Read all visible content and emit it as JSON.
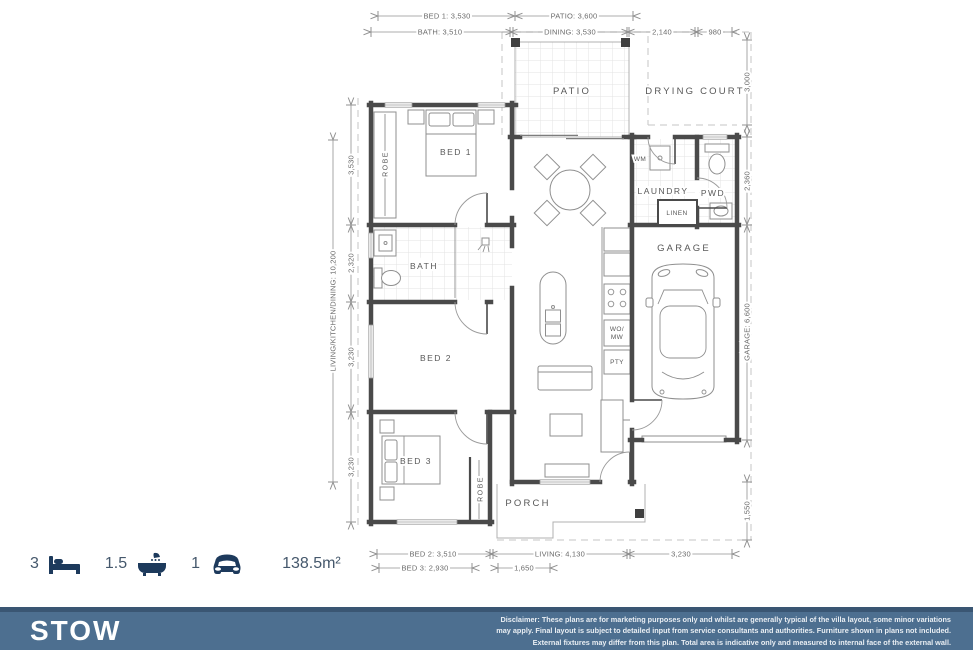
{
  "plan": {
    "dims_top": {
      "bed1": "BED 1: 3,530",
      "patio": "PATIO: 3,600",
      "bath": "BATH: 3,510",
      "dining": "DINING: 3,530",
      "d2140": "2,140",
      "d980": "980"
    },
    "dims_left": {
      "overall": "LIVING/KITCHEN/DINING: 10,200",
      "d3530": "3,530",
      "d2320": "2,320",
      "d3230a": "3,230",
      "d3230b": "3,230"
    },
    "dims_right": {
      "d3000": "3,000",
      "d2360": "2,360",
      "garage": "GARAGE: 6,600",
      "d1550": "1,550"
    },
    "dims_bottom": {
      "bed2": "BED 2: 3,510",
      "living": "LIVING: 4,130",
      "d3230": "3,230",
      "bed3": "BED 3: 2,930",
      "d1650": "1,650"
    },
    "labels": {
      "patio": "PATIO",
      "drying_court": "DRYING COURT",
      "bed1": "BED 1",
      "robe_bed1": "ROBE",
      "bath": "BATH",
      "bed2": "BED 2",
      "bed3": "BED 3",
      "robe_bed3": "ROBE",
      "wm": "WM",
      "laundry": "LAUNDRY",
      "pwd": "PWD",
      "linen": "LINEN",
      "garage": "GARAGE",
      "porch": "PORCH",
      "wo": "WO/",
      "mw": "MW",
      "pty": "PTY"
    }
  },
  "summary": {
    "beds": "3",
    "baths": "1.5",
    "cars": "1",
    "area": "138.5m²"
  },
  "footer": {
    "title": "STOW",
    "disclaimer_line1": "Disclaimer: These plans are for marketing purposes only and whilst are generally typical of the villa layout, some minor variations",
    "disclaimer_line2": "may apply. Final layout is subject to detailed input from service consultants and authorities. Furniture shown in plans not included.",
    "disclaimer_line3": "External fixtures may differ from this plan. Total area is indicative only and measured to internal face of the external wall."
  },
  "colors": {
    "wall": "#4a4a4a",
    "navy_icon": "#1d3a5c",
    "stat_text": "#45586c",
    "footer_bg": "#4d6f90",
    "footer_border": "#3a5673"
  }
}
